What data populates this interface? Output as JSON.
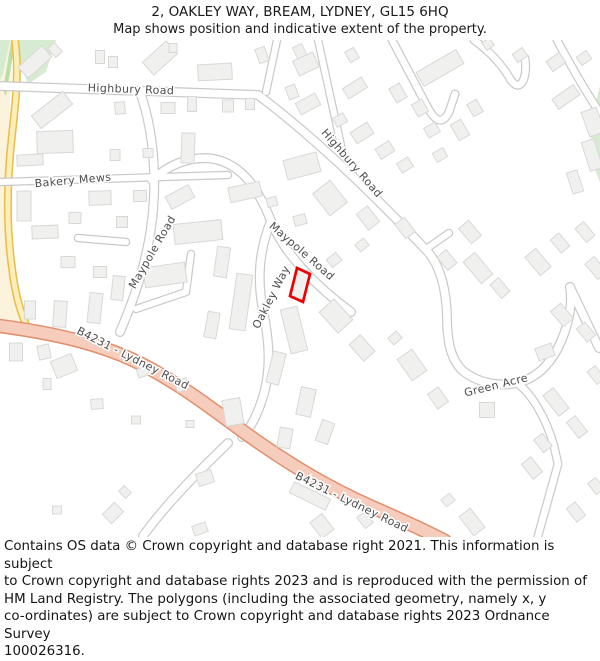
{
  "header": {
    "title": "2, OAKLEY WAY, BREAM, LYDNEY, GL15 6HQ",
    "subtitle": "Map shows position and indicative extent of the property."
  },
  "footer": {
    "text": "Contains OS data © Crown copyright and database right 2021. This information is subject\nto Crown copyright and database rights 2023 and is reproduced with the permission of\nHM Land Registry. The polygons (including the associated geometry, namely x, y\nco-ordinates) are subject to Crown copyright and database rights 2023 Ordnance Survey\n100026316."
  },
  "map": {
    "colors": {
      "road_casing": "#c9c9c9",
      "road_fill": "#ffffff",
      "b_road_casing": "#e0906c",
      "b_road_fill": "#f6ccbc",
      "yellow_casing": "#e7bd4e",
      "yellow_fill": "#fdeeb8",
      "building_fill": "#f0f0ef",
      "building_stroke": "#d8d8d7",
      "green": "#d6ebd1",
      "green_dark": "#b9dfa9",
      "cream": "#fbf3dc",
      "label": "#4d4d4d",
      "plot": "#ee0000"
    },
    "areas": {
      "cream": "0,40 13,40 9,120 5,200 10,265 20,310 30,332 0,332",
      "greens": [
        "0,40 10,40 3,74 0,80",
        "16,40 56,40 46,72 28,84 20,64",
        "600,86 600,182 590,158 593,112"
      ],
      "green_dark_sliver": "11,42 15,42 6,96 3,90"
    },
    "yellow_road": "M 15 40 C 19 70 16 100 12 135 C 7 180 6 225 12 268 C 15 294 21 315 29 331",
    "b4231_road": "M 0 326 C 60 334 112 346 156 372 C 198 396 226 420 258 442 C 300 471 332 489 372 507 C 404 521 428 532 445 541",
    "white_roads": [
      {
        "name": "highbury-road-west",
        "d": "M 0 86 L 258 95"
      },
      {
        "name": "highbury-road-diagonal",
        "d": "M 258 95 C 305 130 365 185 428 252 C 440 266 446 288 447 316"
      },
      {
        "name": "north-stub-1",
        "d": "M 266 92 L 277 40",
        "w": 8.5
      },
      {
        "name": "north-stub-2",
        "d": "M 318 40 L 342 150",
        "w": 8.5
      },
      {
        "name": "cul-de-sac-a",
        "d": "M 392 40 L 428 108 Q 440 130 449 112 L 455 94",
        "w": 9
      },
      {
        "name": "cul-de-sac-b",
        "d": "M 474 40 Q 497 57 509 77 Q 517 91 523 81 Q 527 72 525 58",
        "w": 9
      },
      {
        "name": "right-top-road",
        "d": "M 557 40 Q 583 88 600 113",
        "w": 9
      },
      {
        "name": "maypole-road-vertical",
        "d": "M 140 92 C 157 140 158 200 147 250 C 140 283 130 308 120 332"
      },
      {
        "name": "bakery-mews",
        "d": "M 0 182 L 228 175",
        "w": 8.5
      },
      {
        "name": "west-stub",
        "d": "M 126 242 L 78 238",
        "w": 8.5
      },
      {
        "name": "l-stub",
        "d": "M 136 309 L 186 292 L 191 254",
        "w": 8.5
      },
      {
        "name": "maypole-road-diagonal",
        "d": "M 152 180 Q 176 158 206 158 C 240 160 258 188 271 221 C 284 254 318 288 351 312"
      },
      {
        "name": "oakley-way",
        "d": "M 271 221 C 259 250 257 280 263 310 C 269 340 272 370 262 400 C 256 418 250 428 242 437"
      },
      {
        "name": "south-branch",
        "d": "M 228 443 C 200 470 166 504 143 536"
      },
      {
        "name": "green-acre",
        "d": "M 447 316 C 447 342 451 360 463 371 C 478 383 499 387 517 383 C 542 377 556 356 564 334 C 571 315 572 298 570 287"
      },
      {
        "name": "green-acre-stub",
        "d": "M 429 247 L 449 233",
        "w": 8.5
      },
      {
        "name": "green-acre-right-arm",
        "d": "M 570 287 L 599 348"
      },
      {
        "name": "green-acre-se-branch",
        "d": "M 517 383 C 532 394 546 418 554 446 L 558 464 L 538 536",
        "w": 9
      }
    ],
    "plot": {
      "points": "297,268 310,274 303,302 290,296",
      "color": "#ee0000"
    },
    "road_labels": [
      {
        "slug": "highbury-road-1",
        "text": "Highbury Road",
        "x": 131,
        "y": 89,
        "rot": 2
      },
      {
        "slug": "highbury-road-2",
        "text": "Highbury Road",
        "x": 352,
        "y": 163,
        "rot": 49
      },
      {
        "slug": "bakery-mews",
        "text": "Bakery Mews",
        "x": 73,
        "y": 180,
        "rot": -5
      },
      {
        "slug": "maypole-road-1",
        "text": "Maypole Road",
        "x": 152,
        "y": 252,
        "rot": -60
      },
      {
        "slug": "maypole-road-2",
        "text": "Maypole Road",
        "x": 302,
        "y": 251,
        "rot": 41
      },
      {
        "slug": "oakley-way",
        "text": "Oakley Way",
        "x": 271,
        "y": 297,
        "rot": -63
      },
      {
        "slug": "green-acre",
        "text": "Green Acre",
        "x": 496,
        "y": 385,
        "rot": -14
      },
      {
        "slug": "b4231-lydney-road-1",
        "text": "B4231 - Lydney Road",
        "x": 133,
        "y": 358,
        "rot": 27
      },
      {
        "slug": "b4231-lydney-road-2",
        "text": "B4231 - Lydney Road",
        "x": 352,
        "y": 502,
        "rot": 26
      }
    ],
    "buildings": [
      [
        35,
        62,
        32,
        15,
        -42
      ],
      [
        55,
        50,
        9,
        12,
        -42
      ],
      [
        100,
        57,
        9,
        13,
        0
      ],
      [
        113,
        62,
        9,
        11,
        0
      ],
      [
        160,
        58,
        32,
        17,
        -42
      ],
      [
        173,
        48,
        8,
        9,
        0
      ],
      [
        215,
        72,
        34,
        16,
        -3
      ],
      [
        262,
        55,
        10,
        15,
        -20
      ],
      [
        300,
        52,
        10,
        14,
        -25
      ],
      [
        306,
        64,
        22,
        16,
        -25
      ],
      [
        352,
        55,
        10,
        12,
        -30
      ],
      [
        440,
        68,
        46,
        16,
        -30
      ],
      [
        488,
        44,
        9,
        9,
        -35
      ],
      [
        520,
        55,
        12,
        10,
        -35
      ],
      [
        556,
        62,
        16,
        12,
        -35
      ],
      [
        584,
        58,
        12,
        10,
        -35
      ],
      [
        566,
        97,
        26,
        12,
        -35
      ],
      [
        593,
        122,
        16,
        26,
        -20
      ],
      [
        52,
        110,
        40,
        16,
        -38
      ],
      [
        120,
        108,
        10,
        12,
        -5
      ],
      [
        168,
        108,
        14,
        11,
        0
      ],
      [
        192,
        104,
        9,
        15,
        0
      ],
      [
        228,
        106,
        11,
        12,
        0
      ],
      [
        250,
        104,
        9,
        11,
        0
      ],
      [
        308,
        104,
        22,
        13,
        -28
      ],
      [
        340,
        120,
        12,
        10,
        -30
      ],
      [
        362,
        133,
        20,
        13,
        -32
      ],
      [
        385,
        150,
        16,
        12,
        -32
      ],
      [
        405,
        165,
        13,
        11,
        -32
      ],
      [
        398,
        93,
        12,
        16,
        -30
      ],
      [
        420,
        108,
        12,
        14,
        -30
      ],
      [
        432,
        130,
        13,
        11,
        -30
      ],
      [
        440,
        155,
        12,
        10,
        -30
      ],
      [
        460,
        130,
        12,
        18,
        -30
      ],
      [
        475,
        108,
        11,
        14,
        -30
      ],
      [
        55,
        142,
        36,
        22,
        -2
      ],
      [
        188,
        148,
        13,
        30,
        2
      ],
      [
        115,
        155,
        10,
        11,
        0
      ],
      [
        148,
        153,
        10,
        9,
        0
      ],
      [
        30,
        160,
        26,
        11,
        -3
      ],
      [
        100,
        198,
        22,
        14,
        -2
      ],
      [
        140,
        196,
        13,
        11,
        -2
      ],
      [
        24,
        206,
        14,
        30,
        0
      ],
      [
        245,
        192,
        32,
        15,
        -12
      ],
      [
        198,
        232,
        48,
        20,
        -6
      ],
      [
        165,
        275,
        42,
        20,
        -8
      ],
      [
        75,
        218,
        12,
        11,
        0
      ],
      [
        45,
        232,
        26,
        13,
        -2
      ],
      [
        122,
        222,
        11,
        11,
        0
      ],
      [
        68,
        262,
        14,
        11,
        0
      ],
      [
        100,
        272,
        13,
        11,
        0
      ],
      [
        118,
        288,
        12,
        24,
        6
      ],
      [
        95,
        308,
        13,
        30,
        6
      ],
      [
        60,
        314,
        13,
        26,
        4
      ],
      [
        30,
        310,
        11,
        18,
        0
      ],
      [
        222,
        262,
        13,
        30,
        8
      ],
      [
        241,
        302,
        16,
        56,
        8
      ],
      [
        212,
        325,
        12,
        26,
        10
      ],
      [
        302,
        166,
        34,
        20,
        -15
      ],
      [
        330,
        198,
        22,
        28,
        -38
      ],
      [
        368,
        218,
        14,
        20,
        -38
      ],
      [
        405,
        228,
        12,
        18,
        -38
      ],
      [
        300,
        220,
        12,
        10,
        -15
      ],
      [
        272,
        202,
        10,
        9,
        -15
      ],
      [
        180,
        197,
        26,
        14,
        -28
      ],
      [
        300,
        285,
        13,
        30,
        14
      ],
      [
        334,
        260,
        12,
        10,
        -40
      ],
      [
        362,
        245,
        11,
        9,
        -40
      ],
      [
        336,
        316,
        20,
        28,
        -42
      ],
      [
        362,
        348,
        15,
        22,
        -42
      ],
      [
        395,
        338,
        11,
        9,
        -42
      ],
      [
        412,
        365,
        18,
        26,
        -35
      ],
      [
        438,
        398,
        13,
        18,
        -35
      ],
      [
        294,
        330,
        17,
        45,
        -14
      ],
      [
        276,
        368,
        13,
        32,
        14
      ],
      [
        306,
        402,
        15,
        28,
        12
      ],
      [
        325,
        432,
        13,
        22,
        20
      ],
      [
        233,
        412,
        18,
        26,
        -10
      ],
      [
        285,
        438,
        13,
        20,
        10
      ],
      [
        478,
        268,
        15,
        28,
        -40
      ],
      [
        500,
        288,
        11,
        18,
        -40
      ],
      [
        538,
        262,
        14,
        24,
        -40
      ],
      [
        560,
        243,
        11,
        17,
        -40
      ],
      [
        585,
        232,
        11,
        18,
        -40
      ],
      [
        562,
        315,
        13,
        20,
        -40
      ],
      [
        586,
        332,
        11,
        17,
        -40
      ],
      [
        545,
        352,
        17,
        13,
        -20
      ],
      [
        487,
        410,
        15,
        15,
        0
      ],
      [
        556,
        402,
        13,
        26,
        -38
      ],
      [
        577,
        427,
        11,
        20,
        -38
      ],
      [
        543,
        443,
        11,
        16,
        -38
      ],
      [
        596,
        375,
        10,
        16,
        -38
      ],
      [
        470,
        232,
        13,
        20,
        -40
      ],
      [
        447,
        260,
        12,
        17,
        -40
      ],
      [
        592,
        155,
        13,
        30,
        -18
      ],
      [
        575,
        182,
        11,
        22,
        -18
      ],
      [
        596,
        268,
        12,
        20,
        -40
      ],
      [
        16,
        352,
        13,
        18,
        0
      ],
      [
        44,
        352,
        12,
        14,
        -12
      ],
      [
        64,
        366,
        22,
        18,
        -22
      ],
      [
        143,
        372,
        11,
        9,
        -20
      ],
      [
        182,
        385,
        13,
        11,
        -20
      ],
      [
        47,
        384,
        8,
        11,
        0
      ],
      [
        97,
        404,
        12,
        10,
        -5
      ],
      [
        136,
        420,
        9,
        8,
        0
      ],
      [
        190,
        424,
        8,
        7,
        0
      ],
      [
        310,
        496,
        40,
        12,
        26
      ],
      [
        205,
        478,
        16,
        13,
        -18
      ],
      [
        125,
        492,
        8,
        10,
        -45
      ],
      [
        113,
        513,
        17,
        13,
        -45
      ],
      [
        57,
        510,
        9,
        8,
        0
      ],
      [
        322,
        526,
        15,
        20,
        -38
      ],
      [
        365,
        520,
        10,
        14,
        -38
      ],
      [
        200,
        529,
        14,
        10,
        -20
      ],
      [
        472,
        522,
        14,
        24,
        -38
      ],
      [
        532,
        468,
        12,
        19,
        -38
      ],
      [
        576,
        512,
        11,
        17,
        -38
      ],
      [
        596,
        486,
        10,
        14,
        -38
      ],
      [
        448,
        500,
        11,
        9,
        -38
      ],
      [
        355,
        88,
        22,
        12,
        -32
      ],
      [
        292,
        92,
        10,
        13,
        -20
      ]
    ]
  }
}
